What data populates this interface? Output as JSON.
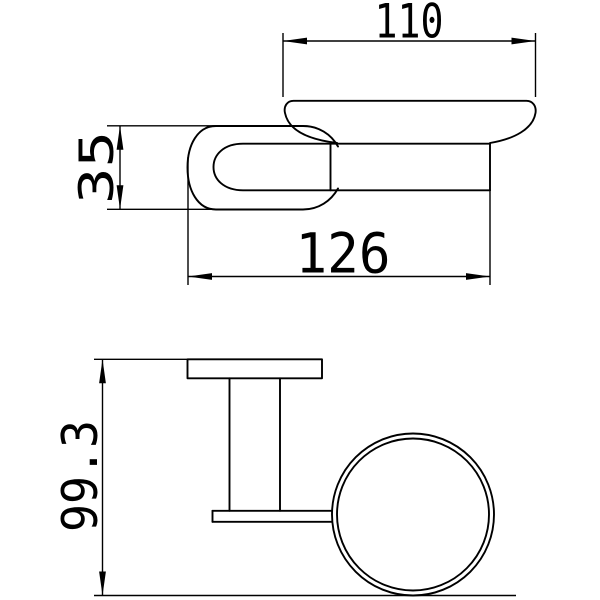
{
  "drawing": {
    "type": "technical-dimension-drawing",
    "dimensions": {
      "dish_width": {
        "value": "110"
      },
      "bracket_height": {
        "value": "35"
      },
      "overall_depth": {
        "value": "126"
      },
      "overall_height": {
        "value": "99.3"
      }
    },
    "colors": {
      "line": "#000000",
      "background": "#ffffff"
    }
  }
}
